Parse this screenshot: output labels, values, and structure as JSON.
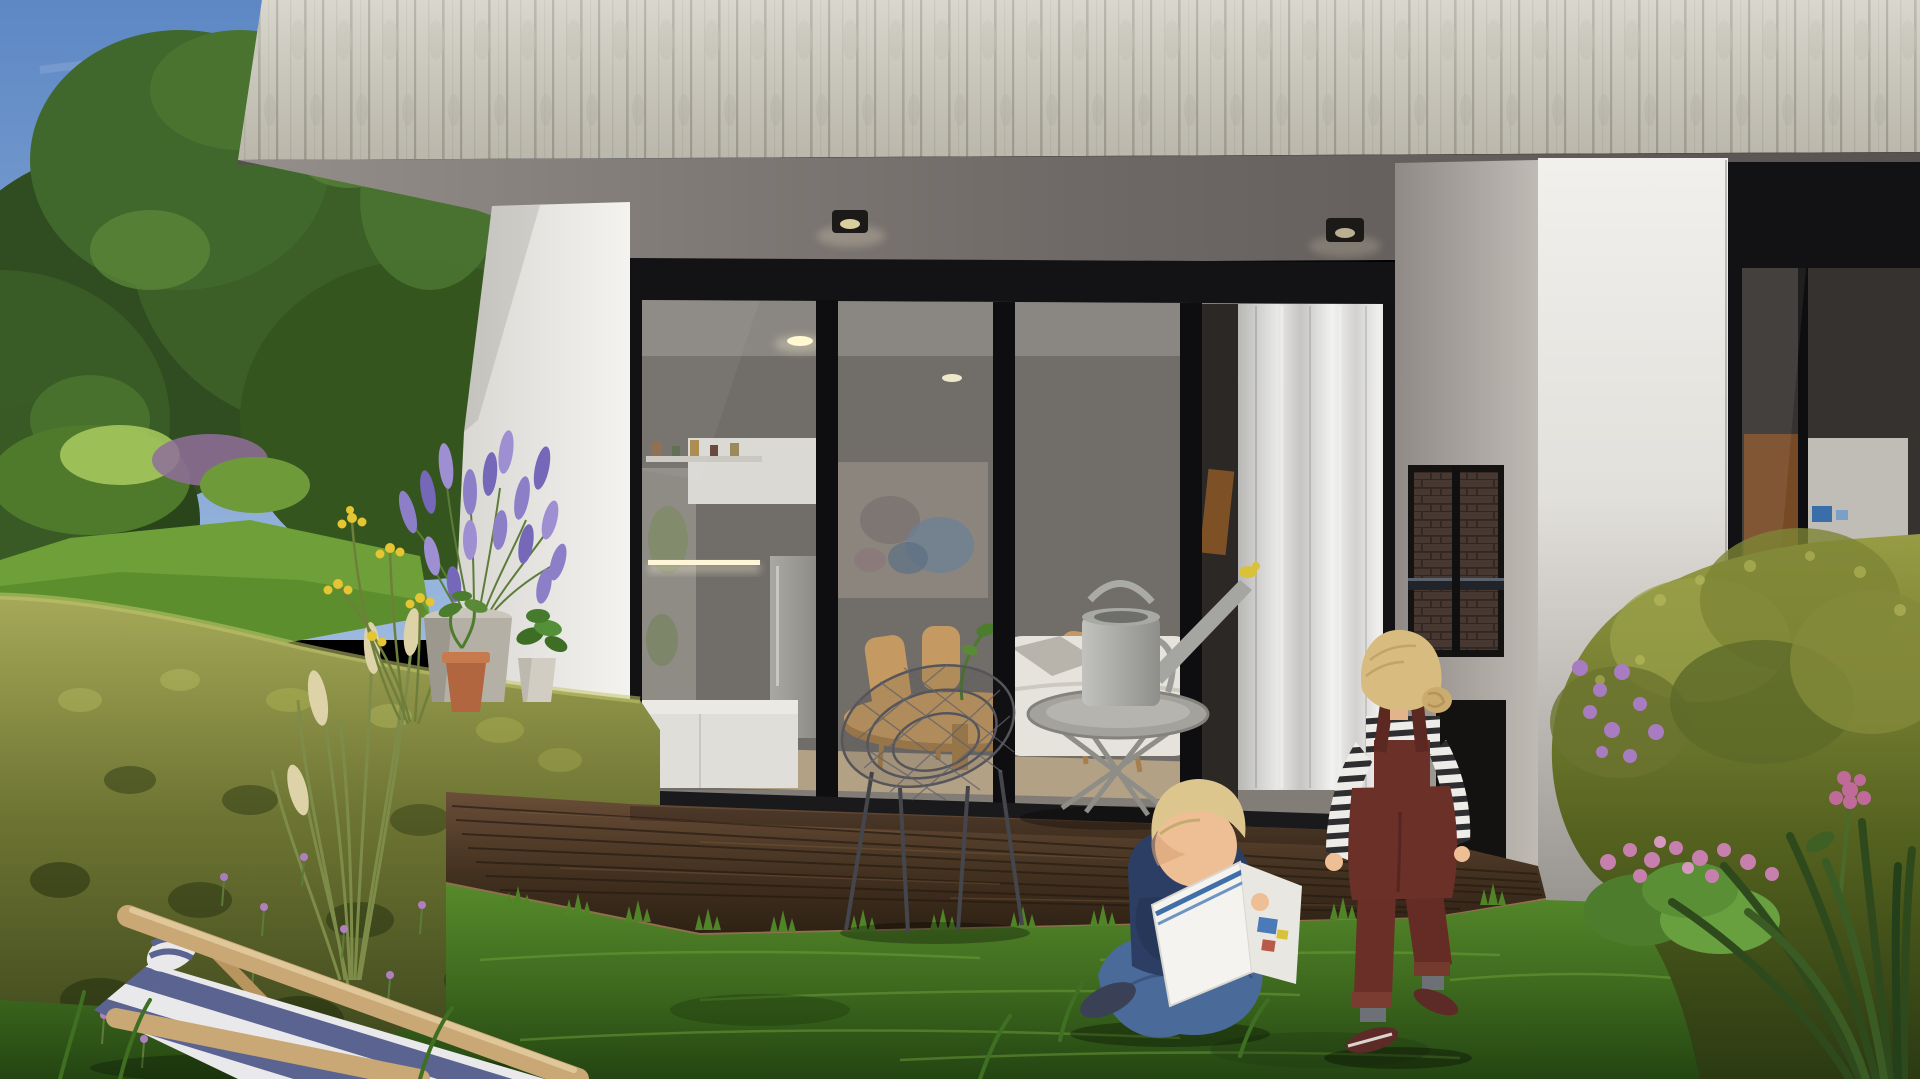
{
  "scene": {
    "title": "Photorealistic exterior rendering: modern concrete-and-glass house with garden terrace, two children playing on the lawn",
    "time_of_day": "sunny afternoon",
    "objects": [
      {
        "name": "sky",
        "description": "clear blue sky, top-left corner"
      },
      {
        "name": "trees",
        "description": "tall leafy garden trees behind the house, left side"
      },
      {
        "name": "concrete-facade",
        "description": "board-formed concrete clad upper storey spanning the top of the image"
      },
      {
        "name": "soffit",
        "description": "grey underside of the cantilevered upper floor with two recessed spotlights"
      },
      {
        "name": "glass-sliding-wall",
        "description": "four-panel black-framed glass wall revealing kitchen, dining table, artwork, sofa and sheer curtain"
      },
      {
        "name": "white-corner-wall",
        "description": "sunlit white wall left of the glazing"
      },
      {
        "name": "fireplace-wall",
        "description": "grey wall with built-in outdoor fireplace niche, brick lining and log store"
      },
      {
        "name": "white-pillar",
        "description": "wide white pier between the two dwelling units"
      },
      {
        "name": "neighbour-unit-glazing",
        "description": "second unit glass wall with timber door visible, far right"
      },
      {
        "name": "hedge",
        "description": "large yellow-green clipped hedge filling the left foreground"
      },
      {
        "name": "deck",
        "description": "dark timber terrace deck in front of the glass wall"
      },
      {
        "name": "lawn",
        "description": "green grass in the foreground"
      },
      {
        "name": "lavender-planter",
        "description": "concrete pot with blooming lavender"
      },
      {
        "name": "yellow-flowers",
        "description": "yellow yarrow flowers beside the lavender"
      },
      {
        "name": "ornamental-grass",
        "description": "tall grass with cream seed plumes"
      },
      {
        "name": "terracotta-pot",
        "description": "small clay pot with green sapling"
      },
      {
        "name": "deck-chair",
        "description": "wooden deck chair with blue and white striped canvas, bottom-left"
      },
      {
        "name": "wire-chair",
        "description": "black wire mesh lounge chair on the deck"
      },
      {
        "name": "side-table",
        "description": "grey round tray table with a metal watering can"
      },
      {
        "name": "boy-reading",
        "description": "blond boy in navy t-shirt and jeans sitting cross-legged on the grass reading a picture book"
      },
      {
        "name": "girl-standing",
        "description": "blonde girl in striped shirt and burgundy dungarees walking toward the fireplace"
      },
      {
        "name": "right-bushes",
        "description": "dense shrubs with purple and pink flowers, right foreground"
      }
    ]
  },
  "palette": {
    "sky_top": "#5d88c4",
    "sky_bottom": "#9cb8de",
    "facade": "#cfccc0",
    "soffit": "#6e6866",
    "window_frame": "#121214",
    "white_wall": "#f2f1ee",
    "fireplace_wall": "#a9a49e",
    "brick": "#5f4b42",
    "curtain": "#dddcda",
    "artwork": "#8b857d",
    "sofa": "#e6e3dc",
    "table_wood": "#c39a63",
    "chair_wood": "#c49a62",
    "fridge": "#9a9894",
    "deck": "#4e3a28",
    "deck_edge": "#8f6f4c",
    "lawn": "#3f6b1f",
    "grass_tuft": "#4f8527",
    "hedge": "#8a8f3e",
    "tree_green": "#3c5f28",
    "lavender": "#8d7fc7",
    "yellow_flower": "#e5c531",
    "purple_flower": "#a87cc0",
    "pink_flower": "#c77fae",
    "planter": "#cbc6bb",
    "terracotta": "#b2663f",
    "plume": "#ddd2a8",
    "fabric_blue": "#5b6490",
    "fabric_white": "#e9e9ec",
    "wire_chair": "#55555a",
    "side_table": "#a3a29c",
    "watering_can": "#a5a5a1",
    "skin": "#eebf94",
    "hair_blond": "#dcc68d",
    "boy_shirt": "#2c3e63",
    "boy_jeans": "#4a6a99",
    "boy_shoes": "#3a4156",
    "book_cover": "#f4f3ef",
    "book_stripe": "#3f6fa8",
    "girl_overalls": "#6b3028",
    "shirt_stripe_dark": "#2e2e31",
    "girl_socks": "#6e7077",
    "girl_shoes": "#5d2a28"
  }
}
